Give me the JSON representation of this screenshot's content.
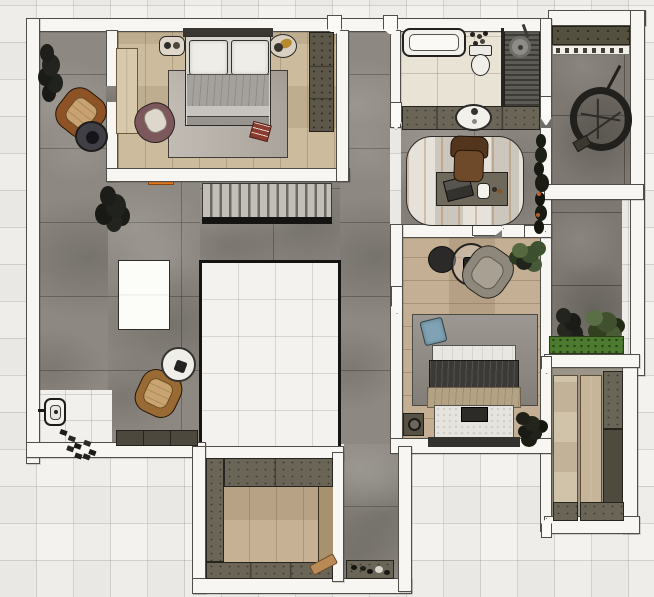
{
  "scene": {
    "description": "Top-down 3D rendered floor plan of an apartment with two bedrooms, bathroom, study, kitchen, balconies and a stairwell void",
    "view": "top-down",
    "visible_text": []
  },
  "palette": {
    "background": "#f3f2ee",
    "grid_line": "#dddad3",
    "wall_fill": "#f7f6f2",
    "wall_outline": "#4c4a45",
    "void_border": "#141413",
    "stone_floor": "#8d8881",
    "stone_floor_dark": "#7d7871",
    "wood_bedroom1": "#c9b697",
    "wood_bedroom2": "#c0a98c",
    "wood_kitchen": "#c2ab8c",
    "tile_bathroom": "#e9e3d6",
    "marble_entry": "#f1f0ec",
    "counter_olive": "#6a6557",
    "cabinet_dark": "#4c483e",
    "shower_slats": "#3c3b36",
    "stair_tread": "#c2bfb9",
    "rug_bedroom1": "#b7b0a8",
    "rug_bedroom2": "#918c84",
    "rug_study": "#ded9cf",
    "duvet_gray": "#a5a29d",
    "duvet_dark": "#3b3a37",
    "blanket_beige": "#b3a284",
    "pillow_white": "#efede8",
    "pillow_blue": "#7fa3b5",
    "armchair_leather": "#8d5226",
    "armchair_plum": "#7c585c",
    "armchair_gray": "#8e887c",
    "office_chair": "#6b4527",
    "red_pillow": "#8a3b2e",
    "plant_green": "#5a6f46",
    "planter_green": "#4c7a2e",
    "accent_orange": "#e0761e"
  },
  "rooms": [
    {
      "id": "living-room",
      "floor": "gray stone tile",
      "items": [
        "dark plant",
        "leather armchair",
        "round coffee table",
        "second dark plant",
        "white island table",
        "leather armchair with round side table",
        "tv cabinet",
        "staircase with orange threshold",
        "stairwell void opening"
      ]
    },
    {
      "id": "entry",
      "floor": "white marble tile",
      "items": [
        "wall intercom",
        "scattered shoes"
      ]
    },
    {
      "id": "bedroom-1",
      "floor": "light wood planks",
      "items": [
        "double bed with two white pillows and gray duvet",
        "area rug",
        "plum armchair",
        "red throw pillow",
        "light wardrobe panel",
        "dark wardrobe cabinet",
        "round wall decor pieces"
      ]
    },
    {
      "id": "bathroom",
      "floor": "beige ceramic tile",
      "items": [
        "bathtub",
        "toiletries",
        "toilet",
        "walk-in shower with slatted floor",
        "shower head",
        "vanity counter with round sink"
      ]
    },
    {
      "id": "study",
      "floor": "gray stone tile",
      "items": [
        "striped area rug",
        "desk",
        "laptop",
        "mug",
        "office chair",
        "wall plants"
      ]
    },
    {
      "id": "bedroom-2",
      "floor": "wood planks",
      "items": [
        "double bed with dark duvet and beige blanket",
        "gray rug",
        "blue cushion",
        "gray armchair",
        "round side table",
        "glass side table",
        "potted plant",
        "nightstand with lamp",
        "nightstand plant"
      ]
    },
    {
      "id": "balcony-top",
      "floor": "dark stone tile",
      "items": [
        "storage shelf",
        "white shelf with accessories",
        "round hanging chair"
      ]
    },
    {
      "id": "balcony-right",
      "floor": "dark stone tile",
      "items": [
        "dark plant",
        "leafy plant",
        "green planter box"
      ]
    },
    {
      "id": "closet-room",
      "floor": "light wood panels",
      "items": [
        "wardrobe column",
        "low cabinets"
      ]
    },
    {
      "id": "kitchen",
      "floor": "wood planks",
      "items": [
        "left counter column",
        "top counter",
        "right counter strip",
        "bottom counter",
        "cutting board"
      ]
    },
    {
      "id": "corridor",
      "floor": "gray stone tile",
      "items": [
        "shoe cabinet",
        "scattered shoes"
      ]
    }
  ]
}
